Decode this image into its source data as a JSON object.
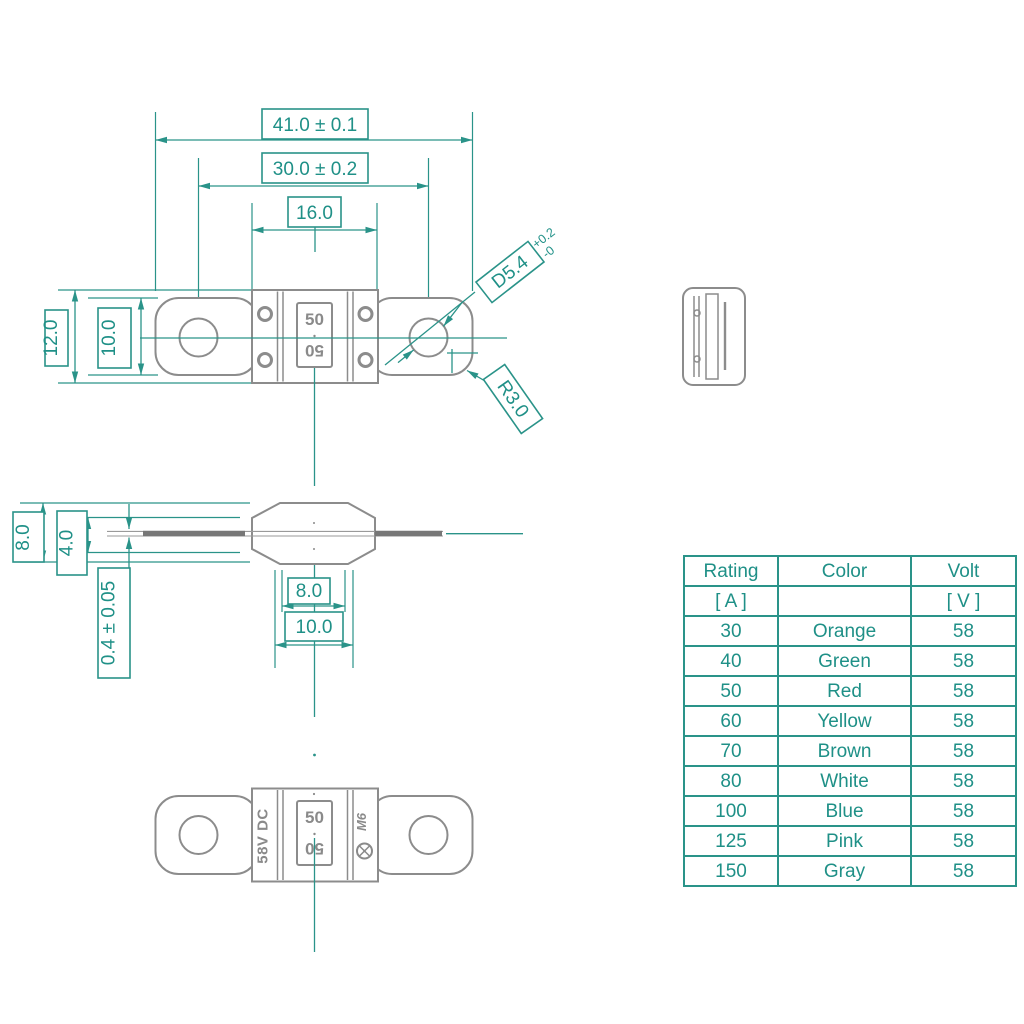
{
  "drawing": {
    "dims": {
      "overall_width": "41.0 ± 0.1",
      "hole_spacing": "30.0 ± 0.2",
      "body_width": "16.0",
      "body_height": "12.0",
      "terminal_height": "10.0",
      "hole_diameter": "D5.4",
      "hole_diameter_tol_plus": "+0.2",
      "hole_diameter_tol_minus": "-0",
      "corner_radius": "R3.0",
      "side_height": "8.0",
      "slot_height": "4.0",
      "terminal_thickness": "0.4 ± 0.05",
      "base_inner_width": "8.0",
      "base_outer_width": "10.0"
    },
    "part_labels": {
      "rating_top": "50",
      "rating_bottom": "50",
      "voltage_marking": "58V DC",
      "brand_mark": "M6"
    }
  },
  "table": {
    "headers": {
      "rating": "Rating",
      "color": "Color",
      "volt": "Volt"
    },
    "units": {
      "rating": "[ A ]",
      "volt": "[ V ]"
    },
    "rows": [
      {
        "rating": "30",
        "color": "Orange",
        "volt": "58"
      },
      {
        "rating": "40",
        "color": "Green",
        "volt": "58"
      },
      {
        "rating": "50",
        "color": "Red",
        "volt": "58"
      },
      {
        "rating": "60",
        "color": "Yellow",
        "volt": "58"
      },
      {
        "rating": "70",
        "color": "Brown",
        "volt": "58"
      },
      {
        "rating": "80",
        "color": "White",
        "volt": "58"
      },
      {
        "rating": "100",
        "color": "Blue",
        "volt": "58"
      },
      {
        "rating": "125",
        "color": "Pink",
        "volt": "58"
      },
      {
        "rating": "150",
        "color": "Gray",
        "volt": "58"
      }
    ]
  },
  "colors": {
    "accent_teal": "#2a9389",
    "outline_gray": "#8c8c8c"
  }
}
